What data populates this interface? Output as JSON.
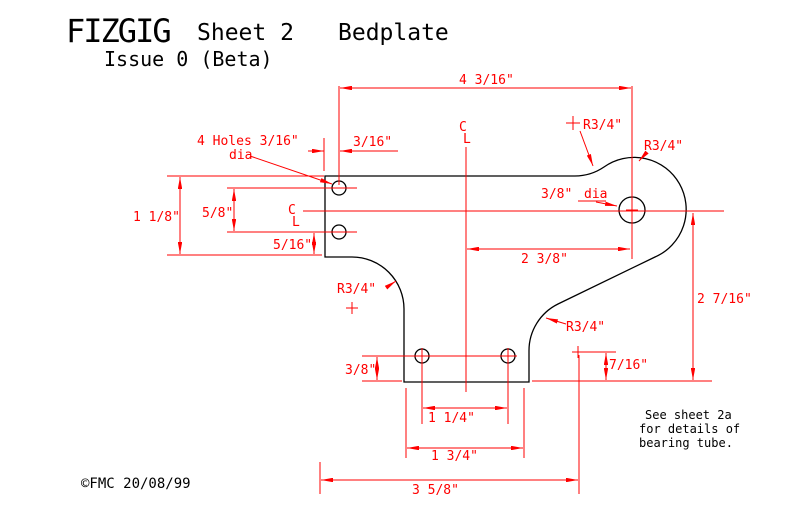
{
  "colors": {
    "dimension_red": "#ff0000",
    "outline_black": "#000000",
    "background": "#ffffff"
  },
  "title": {
    "product": "FIZGIG",
    "sheet": "Sheet 2",
    "component": "Bedplate",
    "issue": "Issue 0 (Beta)"
  },
  "copyright": "©FMC 20/08/99",
  "note": {
    "lines": [
      "See sheet 2a",
      "for details of",
      "bearing tube."
    ]
  },
  "centerline": {
    "c": "C",
    "l": "L"
  },
  "annotations": {
    "holes_note": "4 Holes 3/16\"",
    "holes_note_dia": "dia",
    "bearing_dia": "3/8\"",
    "bearing_dia_word": "dia",
    "radius": "R3/4\""
  },
  "dimensions": {
    "overall_width_top": "4 3/16\"",
    "hole_inset": "3/16\"",
    "flange_height": "1 1/8\"",
    "hole_pitch": "5/8\"",
    "hole_to_flange_bottom": "5/16\"",
    "centre_to_bearing": "2 3/8\"",
    "centre_to_base": "2 7/16\"",
    "base_hole_height": "3/8\"",
    "fillet_centre_height": "7/16\"",
    "base_hole_pitch": "1 1/4\"",
    "base_width": "1 3/4\"",
    "overall_width_bottom": "3 5/8\""
  }
}
